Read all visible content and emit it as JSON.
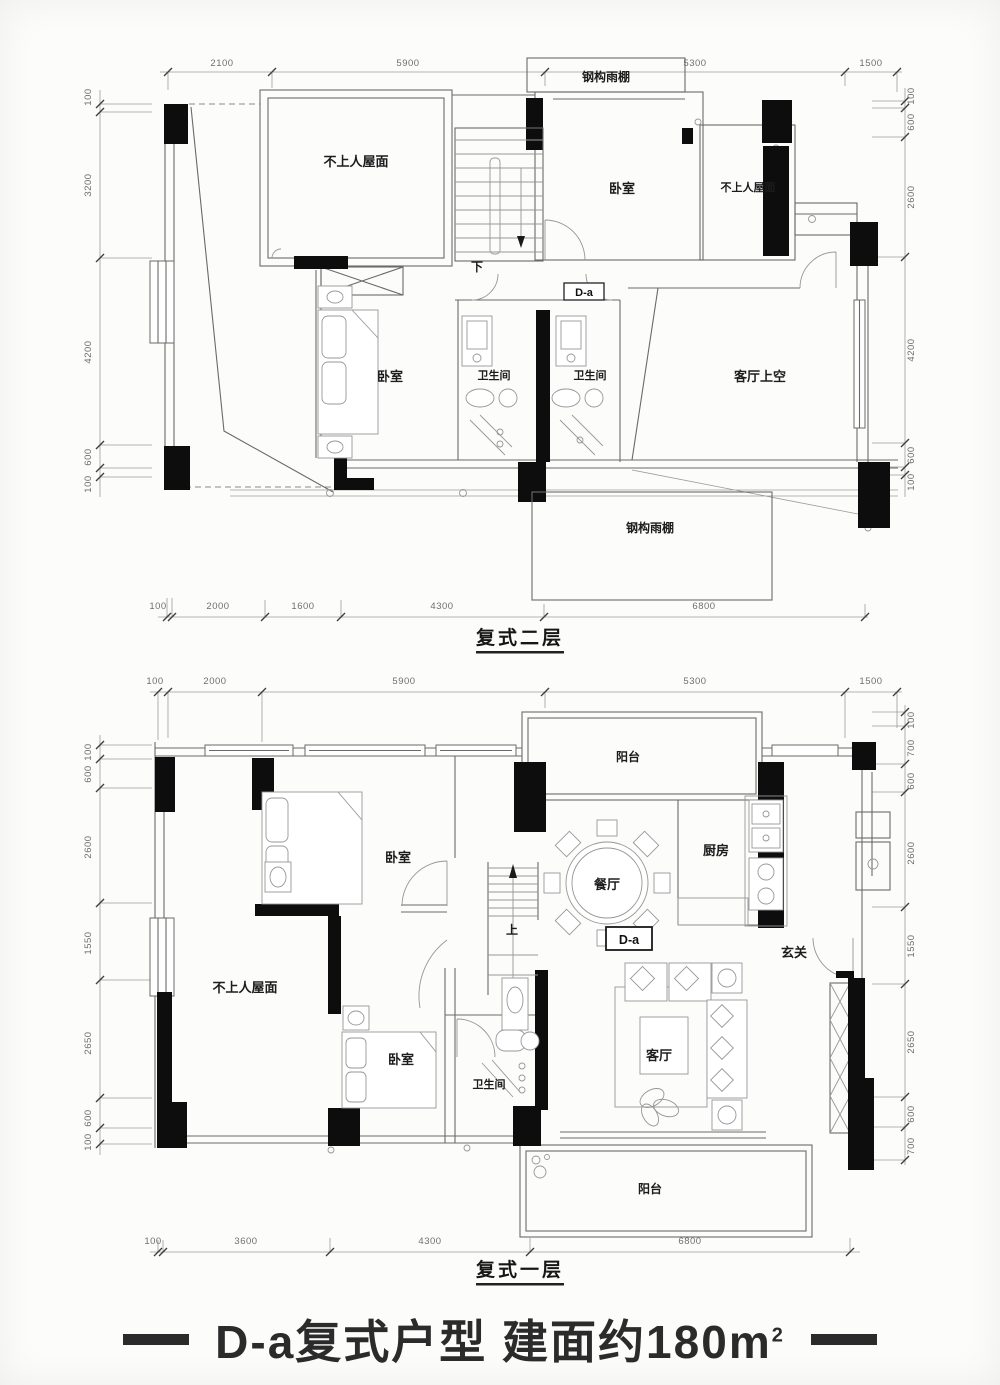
{
  "palette": {
    "wall_fill": "#0d0d0d",
    "line": "#6a6a6a",
    "furniture_line": "#979797",
    "dim_text": "#6f6f6f",
    "label_text": "#1c1c1c",
    "background": "#fcfcfb",
    "footer_text": "#2b2b2b"
  },
  "second_floor": {
    "name": "复式二层",
    "dims_top": [
      "2100",
      "5900",
      "5300",
      "1500"
    ],
    "dims_bottom": [
      "100",
      "2000",
      "1600",
      "4300",
      "6800"
    ],
    "dims_left": [
      "100",
      "3200",
      "4200",
      "600",
      "100"
    ],
    "dims_right": [
      "100",
      "600",
      "2600",
      "4200",
      "600",
      "100"
    ],
    "rooms": {
      "canopy_top": "钢构雨棚",
      "roof_left": "不上人屋面",
      "bedroom_top": "卧室",
      "roof_right": "不上人屋面",
      "bedroom_mid": "卧室",
      "bath_left": "卫生间",
      "bath_right": "卫生间",
      "living_void": "客厅上空",
      "canopy_bottom": "钢构雨棚"
    },
    "stair_label": "下",
    "unit_tag": "D-a"
  },
  "first_floor": {
    "name": "复式一层",
    "dims_top": [
      "100",
      "2000",
      "5900",
      "5300",
      "1500"
    ],
    "dims_bottom": [
      "100",
      "3600",
      "4300",
      "6800"
    ],
    "dims_left": [
      "100",
      "600",
      "2600",
      "1550",
      "2650",
      "600",
      "100"
    ],
    "dims_right": [
      "100",
      "700",
      "600",
      "2600",
      "1550",
      "2650",
      "600",
      "700"
    ],
    "rooms": {
      "balcony_top": "阳台",
      "bedroom_top": "卧室",
      "dining": "餐厅",
      "kitchen": "厨房",
      "foyer": "玄关",
      "roof_left": "不上人屋面",
      "bedroom_bottom": "卧室",
      "bath": "卫生间",
      "living": "客厅",
      "balcony_bottom": "阳台"
    },
    "stair_label": "上",
    "unit_tag": "D-a"
  },
  "footer": {
    "title_main": "D-a复式户型 建面约180",
    "unit": "m",
    "unit_sup": "2"
  }
}
